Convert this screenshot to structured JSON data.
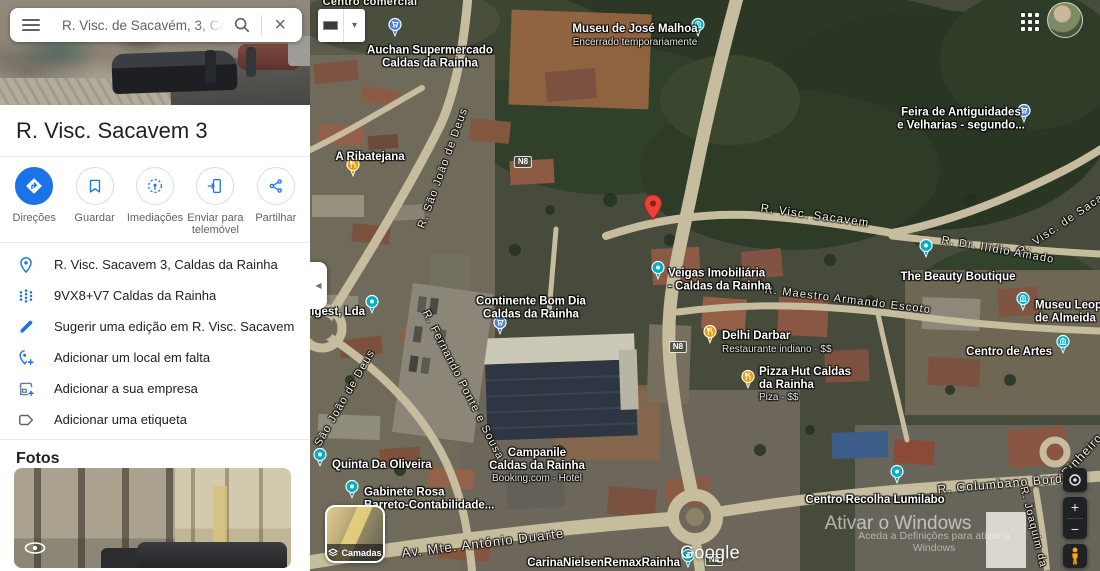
{
  "search": {
    "value": "R. Visc. de Sacavém, 3, Caldas d"
  },
  "place": {
    "title": "R. Visc. Sacavem 3"
  },
  "actions": [
    {
      "id": "directions",
      "label": "Direções"
    },
    {
      "id": "save",
      "label": "Guardar"
    },
    {
      "id": "nearby",
      "label": "Imediações"
    },
    {
      "id": "send-to-phone",
      "label": "Enviar para telemóvel"
    },
    {
      "id": "share",
      "label": "Partilhar"
    }
  ],
  "details": [
    {
      "icon": "place-pin",
      "text": "R. Visc. Sacavem 3, Caldas da Rainha"
    },
    {
      "icon": "plus-code",
      "text": "9VX8+V7 Caldas da Rainha"
    },
    {
      "icon": "pencil",
      "text": "Sugerir uma edição em R. Visc. Sacavem 3"
    },
    {
      "icon": "add-place",
      "text": "Adicionar um local em falta"
    },
    {
      "icon": "storefront",
      "text": "Adicionar a sua empresa"
    },
    {
      "icon": "tag",
      "text": "Adicionar uma etiqueta"
    }
  ],
  "photos": {
    "heading": "Fotos"
  },
  "colors": {
    "accent": "#1a73e8",
    "pin_shopping": "#4d7fe3",
    "pin_food": "#f29900",
    "pin_generic": "#00aec6",
    "pin_museum": "#00aec6",
    "marker_red": "#ea4335"
  },
  "map": {
    "layers_label": "Camadas",
    "google_logo": "Google",
    "watermark": {
      "line1": "Ativar o Windows",
      "line2": "Aceda a Definições para ativar o Windows"
    },
    "controls": {
      "zoom_in": "+",
      "zoom_out": "−"
    },
    "shields": [
      {
        "text": "N8",
        "x": 213,
        "y": 162
      },
      {
        "text": "N8",
        "x": 368,
        "y": 347
      },
      {
        "text": "N8",
        "x": 404,
        "y": 560
      }
    ],
    "streets": [
      {
        "text": "Centro comercial",
        "x": 60,
        "y": 2,
        "rot": 0,
        "kind": "area",
        "size": 11
      },
      {
        "text": "R. Visc. Sacavem",
        "x": 505,
        "y": 216,
        "rot": 8,
        "size": 11.5
      },
      {
        "text": "R. Visc. de Sacavém",
        "x": 761,
        "y": 218,
        "rot": -34,
        "size": 11
      },
      {
        "text": "R. Dr. Ilídio Amado",
        "x": 688,
        "y": 250,
        "rot": 10,
        "size": 11
      },
      {
        "text": "R. Maestro Armando Escoto",
        "x": 538,
        "y": 300,
        "rot": 7,
        "size": 11
      },
      {
        "text": "R. São João de Deus",
        "x": 133,
        "y": 168,
        "rot": -70,
        "size": 11
      },
      {
        "text": "São João de Deus",
        "x": 35,
        "y": 398,
        "rot": -60,
        "size": 11
      },
      {
        "text": "R. Fernando Ponte e Sousa",
        "x": 153,
        "y": 385,
        "rot": 63,
        "size": 11
      },
      {
        "text": "Av. Mte. António Duarte",
        "x": 173,
        "y": 543,
        "rot": -7,
        "size": 13
      },
      {
        "text": "R. Columbano Bordalo",
        "x": 700,
        "y": 483,
        "rot": -5,
        "size": 12
      },
      {
        "text": "Pinheiro",
        "x": 772,
        "y": 455,
        "rot": -47,
        "size": 12
      },
      {
        "text": "R. Joaquim da S",
        "x": 725,
        "y": 533,
        "rot": 76,
        "size": 10.5
      }
    ],
    "pois": [
      {
        "id": "auchan",
        "pin": {
          "x": 85,
          "y": 33,
          "kind": "shopping"
        },
        "label": {
          "x": 120,
          "y": 57,
          "align": "center",
          "lines": [
            "Auchan Supermercado",
            "Caldas da Rainha"
          ]
        }
      },
      {
        "id": "museu-jose-malhoa",
        "pin": {
          "x": 388,
          "y": 33,
          "kind": "museum"
        },
        "label": {
          "x": 325,
          "y": 36,
          "align": "center",
          "lines": [
            "Museu de José Malhoa"
          ],
          "sub": "Encerrado temporariamente"
        }
      },
      {
        "id": "feira-antiguidades",
        "pin": {
          "x": 714,
          "y": 119,
          "kind": "shopping"
        },
        "label": {
          "x": 651,
          "y": 119,
          "align": "center",
          "lines": [
            "Feira de Antiguidades",
            "e Velharias - segundo..."
          ]
        }
      },
      {
        "id": "a-ribatejana",
        "pin": {
          "x": 43,
          "y": 173,
          "kind": "food"
        },
        "label": {
          "x": 60,
          "y": 157,
          "align": "center",
          "lines": [
            "A Ribatejana"
          ]
        }
      },
      {
        "id": "veigas-imobiliaria",
        "pin": {
          "x": 348,
          "y": 276,
          "kind": "generic"
        },
        "label": {
          "x": 358,
          "y": 280,
          "align": "left",
          "lines": [
            "Veigas Imobiliária",
            "- Caldas da Rainha"
          ]
        }
      },
      {
        "id": "the-beauty-boutique",
        "pin": {
          "x": 616,
          "y": 254,
          "kind": "generic"
        },
        "label": {
          "x": 648,
          "y": 277,
          "align": "center",
          "lines": [
            "The Beauty Boutique"
          ]
        }
      },
      {
        "id": "continente-bom-dia",
        "pin": {
          "x": 190,
          "y": 331,
          "kind": "shopping"
        },
        "label": {
          "x": 221,
          "y": 308,
          "align": "center",
          "lines": [
            "Continente Bom Dia",
            "Caldas da Rainha"
          ]
        }
      },
      {
        "id": "oligest",
        "pin": {
          "x": 62,
          "y": 310,
          "kind": "generic"
        },
        "label": {
          "x": 55,
          "y": 312,
          "align": "right",
          "lines": [
            "Oligest, Lda"
          ]
        }
      },
      {
        "id": "delhi-darbar",
        "pin": {
          "x": 400,
          "y": 340,
          "kind": "food"
        },
        "label": {
          "x": 412,
          "y": 343,
          "align": "left",
          "lines": [
            "Delhi Darbar"
          ],
          "sub": "Restaurante indiano · $$"
        }
      },
      {
        "id": "pizza-hut",
        "pin": {
          "x": 438,
          "y": 385,
          "kind": "food"
        },
        "label": {
          "x": 449,
          "y": 385,
          "align": "left",
          "lines": [
            "Pizza Hut Caldas",
            "da Rainha"
          ],
          "sub": "Piza · $$"
        }
      },
      {
        "id": "museu-leopoldo",
        "pin": {
          "x": 713,
          "y": 307,
          "kind": "museum"
        },
        "label": {
          "x": 725,
          "y": 312,
          "align": "left",
          "lines": [
            "Museu Leopoldo",
            "de Almeida"
          ]
        }
      },
      {
        "id": "centro-de-artes",
        "pin": {
          "x": 753,
          "y": 350,
          "kind": "museum"
        },
        "label": {
          "x": 742,
          "y": 352,
          "align": "right",
          "lines": [
            "Centro de Artes"
          ]
        }
      },
      {
        "id": "quinta-da-oliveira",
        "pin": {
          "x": 10,
          "y": 463,
          "kind": "generic"
        },
        "label": {
          "x": 22,
          "y": 465,
          "align": "left",
          "lines": [
            "Quinta Da Oliveira"
          ]
        }
      },
      {
        "id": "gabinete-rosa",
        "pin": {
          "x": 42,
          "y": 495,
          "kind": "generic"
        },
        "label": {
          "x": 54,
          "y": 499,
          "align": "left",
          "lines": [
            "Gabinete Rosa",
            "Barreto-Contabilidade..."
          ]
        }
      },
      {
        "id": "campanile",
        "pin": null,
        "label": {
          "x": 227,
          "y": 466,
          "align": "center",
          "lines": [
            "Campanile",
            "Caldas da Rainha"
          ],
          "sub": "Booking.com · Hotel"
        }
      },
      {
        "id": "centro-recolha-lumilabo",
        "pin": {
          "x": 587,
          "y": 480,
          "kind": "generic"
        },
        "label": {
          "x": 565,
          "y": 500,
          "align": "center",
          "lines": [
            "Centro Recolha Lumilabo"
          ]
        }
      },
      {
        "id": "carina-nielsen-remax",
        "pin": {
          "x": 378,
          "y": 564,
          "kind": "generic"
        },
        "label": {
          "x": 370,
          "y": 563,
          "align": "right",
          "lines": [
            "CarinaNielsenRemaxRainha"
          ]
        }
      }
    ]
  }
}
